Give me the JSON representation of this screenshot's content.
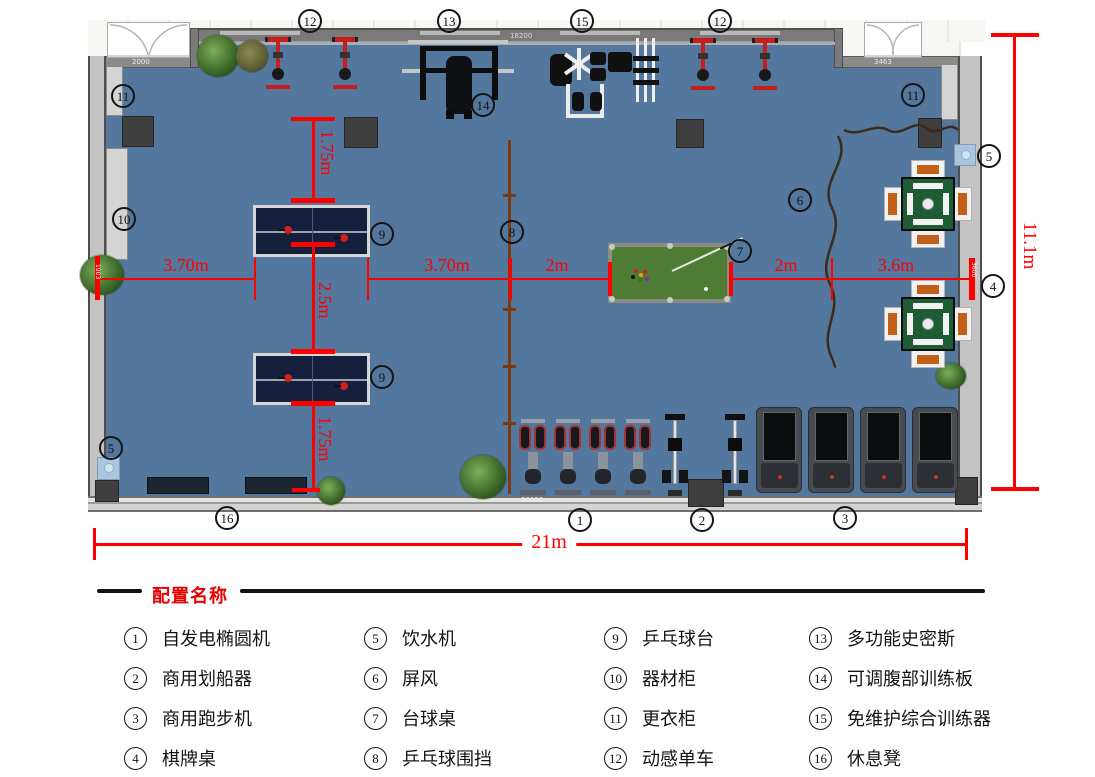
{
  "plan": {
    "markers": [
      "12",
      "13",
      "15",
      "12",
      "11",
      "11",
      "5",
      "14",
      "10",
      "9",
      "8",
      "6",
      "7",
      "4",
      "9",
      "5",
      "16",
      "1",
      "2",
      "3"
    ],
    "dims": {
      "seg1": "3.70m",
      "seg2": "3.70m",
      "seg3": "2m",
      "seg4": "2m",
      "seg5": "3.6m",
      "v1": "1.75m",
      "v2": "2.5m",
      "v3": "1.75m",
      "total_width": "21m",
      "total_height": "11.1m"
    },
    "annos": {
      "left_door": "2000",
      "top_wall": "18200",
      "right_door": "3463",
      "bottom_wall": "20000",
      "h_start": "1903",
      "h_end": "3600"
    }
  },
  "legend": {
    "title": "配置名称",
    "items": [
      {
        "num": "1",
        "label": "自发电椭圆机"
      },
      {
        "num": "2",
        "label": "商用划船器"
      },
      {
        "num": "3",
        "label": "商用跑步机"
      },
      {
        "num": "4",
        "label": "棋牌桌"
      },
      {
        "num": "5",
        "label": "饮水机"
      },
      {
        "num": "6",
        "label": "屏风"
      },
      {
        "num": "7",
        "label": "台球桌"
      },
      {
        "num": "8",
        "label": "乒乓球围挡"
      },
      {
        "num": "9",
        "label": "乒乓球台"
      },
      {
        "num": "10",
        "label": "器材柜"
      },
      {
        "num": "11",
        "label": "更衣柜"
      },
      {
        "num": "12",
        "label": "动感单车"
      },
      {
        "num": "13",
        "label": "多功能史密斯"
      },
      {
        "num": "14",
        "label": "可调腹部训练板"
      },
      {
        "num": "15",
        "label": "免维护综合训练器"
      },
      {
        "num": "16",
        "label": "休息凳"
      }
    ]
  }
}
